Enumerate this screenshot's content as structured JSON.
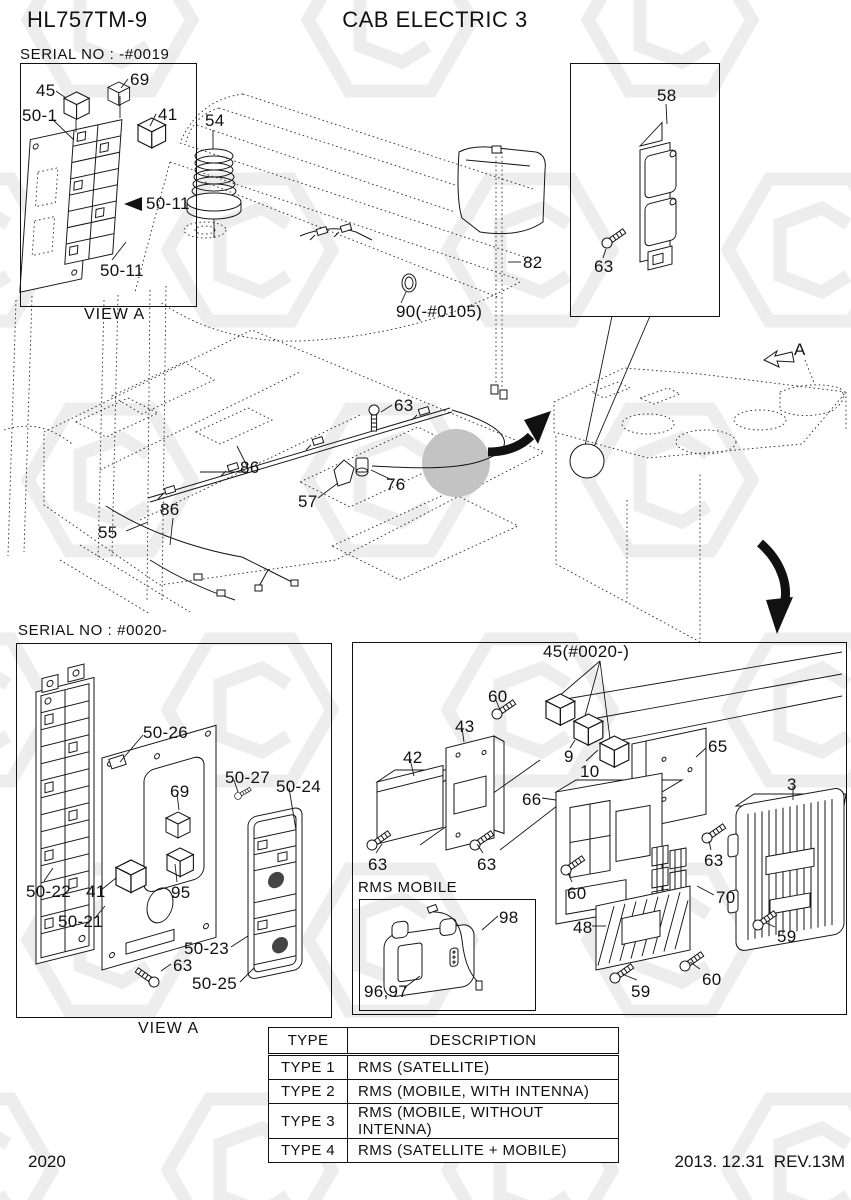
{
  "header": {
    "model": "HL757TM-9",
    "title": "CAB ELECTRIC 3"
  },
  "view_0019": {
    "serial": "SERIAL NO : -#0019",
    "view": "VIEW A",
    "callouts": [
      "45",
      "69",
      "50-1",
      "41",
      "50-11",
      "50-11"
    ]
  },
  "main": {
    "callouts": [
      "54",
      "58",
      "63",
      "82",
      "90(-#0105)",
      "63",
      "86",
      "86",
      "55",
      "57",
      "76"
    ],
    "direction_label": "A"
  },
  "view_0020": {
    "serial": "SERIAL NO : #0020-",
    "view": "VIEW A",
    "callouts": [
      "50-26",
      "50-27",
      "50-24",
      "69",
      "50-22",
      "41",
      "95",
      "50-21",
      "50-23",
      "63",
      "50-25"
    ]
  },
  "exploded": {
    "rms_label": "RMS MOBILE",
    "callouts": [
      "45(#0020-)",
      "60",
      "43",
      "42",
      "9",
      "10",
      "65",
      "66",
      "3",
      "63",
      "63",
      "63",
      "70",
      "60",
      "48",
      "98",
      "96,97",
      "59",
      "60",
      "59"
    ]
  },
  "table": {
    "headers": [
      "TYPE",
      "DESCRIPTION"
    ],
    "rows": [
      [
        "TYPE 1",
        "RMS (SATELLITE)"
      ],
      [
        "TYPE 2",
        "RMS (MOBILE, WITH INTENNA)"
      ],
      [
        "TYPE 3",
        "RMS (MOBILE, WITHOUT INTENNA)"
      ],
      [
        "TYPE 4",
        "RMS (SATELLITE + MOBILE)"
      ]
    ]
  },
  "footer": {
    "page": "2020",
    "revision": "2013. 12.31  REV.13M"
  },
  "colors": {
    "ink": "#111111",
    "watermark": "#ededed",
    "zoom_circle": "#c3c3c3"
  }
}
